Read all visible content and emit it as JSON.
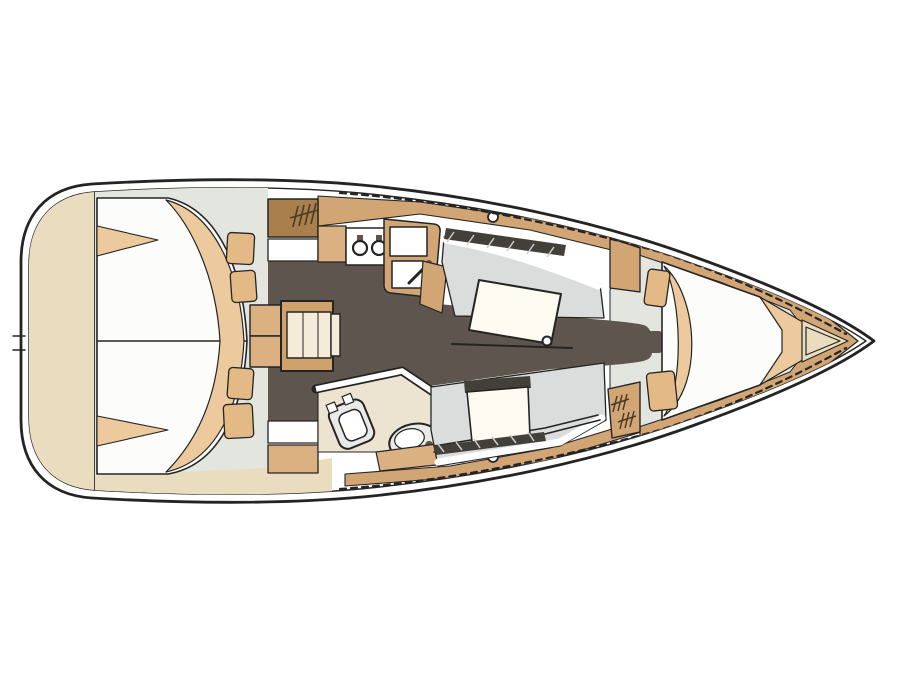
{
  "document": {
    "type": "sailboat-interior-floor-plan",
    "orientation": "bow-right",
    "visible_text": ""
  },
  "colors": {
    "line": "#242424",
    "hull_fill": "#ffffff",
    "beige": "#eadcbe",
    "cabin_bg": "#e3e6df",
    "mattress": "#fcfcfb",
    "blanket": "#ecca9d",
    "pillow": "#e3ba85",
    "wood": "#d2a674",
    "wood2": "#dcb181",
    "wood_dark": "#a97f4c",
    "floor": "#5e564e",
    "settee": "#dadddc",
    "white": "#ffffff",
    "table_frame": "#d0a26b",
    "table_leaf": "#f4ecd9",
    "head_floor": "#ece4d0",
    "fixture": "#e9e9e6",
    "dark_band": "#43403a",
    "band_tick": "#cccccc",
    "mark": "#4a3a26",
    "table_white": "#fdfbf1"
  },
  "regions": [
    {
      "id": "transom",
      "name": "stern-swim-platform"
    },
    {
      "id": "aft-cabin",
      "name": "aft-double-berth-cabin"
    },
    {
      "id": "companionway",
      "name": "companionway-steps"
    },
    {
      "id": "saloon-table",
      "name": "saloon-folding-table"
    },
    {
      "id": "galley",
      "name": "galley-with-stove-and-double-sink"
    },
    {
      "id": "head",
      "name": "head-with-toilet-and-basin"
    },
    {
      "id": "saloon",
      "name": "saloon-settees-with-tables"
    },
    {
      "id": "forward-cabin",
      "name": "forward-v-berth-cabin"
    },
    {
      "id": "anchor-locker",
      "name": "bow-anchor-locker"
    }
  ]
}
